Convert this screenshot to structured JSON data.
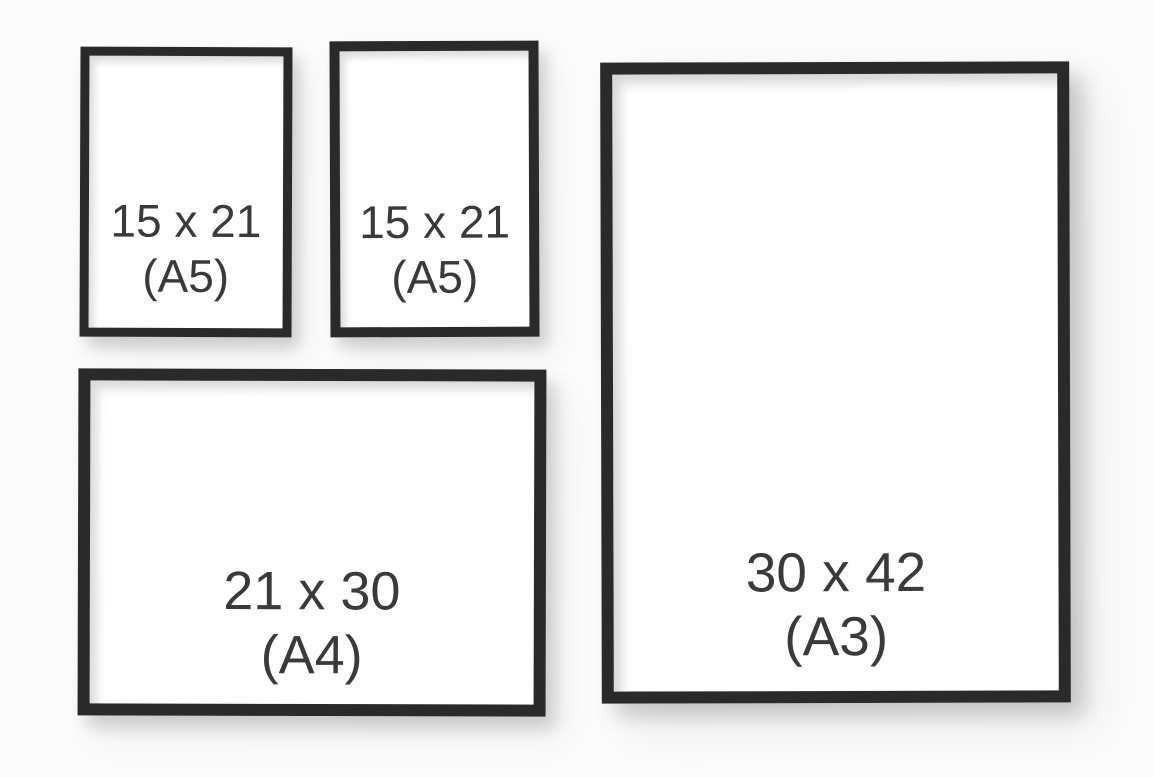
{
  "title": "Frame size comparison",
  "colors": {
    "background": "#fbfbfb",
    "frame": "#2a2a2a",
    "paper": "#ffffff",
    "text": "#3a3a3a"
  },
  "frames": [
    {
      "id": "a5-left",
      "size_label": "15 x 21",
      "format_label": "(A5)"
    },
    {
      "id": "a5-middle",
      "size_label": "15 x 21",
      "format_label": "(A5)"
    },
    {
      "id": "a4",
      "size_label": "21 x 30",
      "format_label": "(A4)"
    },
    {
      "id": "a3",
      "size_label": "30 x 42",
      "format_label": "(A3)"
    }
  ]
}
